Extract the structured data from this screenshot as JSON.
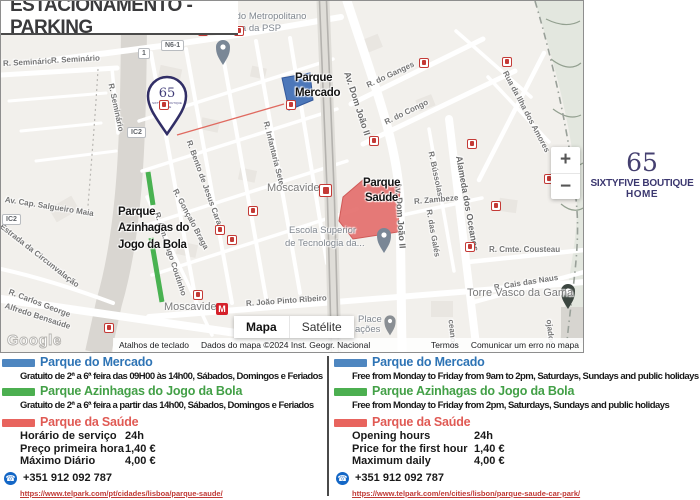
{
  "title": "ESTACIONAMENTO - PARKING",
  "brand": {
    "number": "65",
    "line1": "SIXTYFIVE BOUTIQUE",
    "line2": "HOME"
  },
  "colors": {
    "blue_title": "#2e74b5",
    "green_title": "#43a047",
    "red_title": "#e05a54",
    "blue_swatch": "#4e86c0",
    "green_swatch": "#4caf50",
    "red_swatch": "#e8645e",
    "mercado_area": "#3e6db4",
    "saude_area": "#e4706e",
    "azinhagas_line": "#3fae49"
  },
  "map": {
    "controls": {
      "zoom_in": "+",
      "zoom_out": "−",
      "map_btn": "Mapa",
      "satellite_btn": "Satélite"
    },
    "attribution": {
      "shortcuts": "Atalhos de teclado",
      "data": "Dados do mapa ©2024 Inst. Geogr. Nacional",
      "terms": "Termos",
      "report": "Comunicar um erro no mapa"
    },
    "google_logo": "Google",
    "stations": {
      "metro_label": "M"
    },
    "badges": [
      {
        "t": "N6-1",
        "x": 160,
        "y": 39
      },
      {
        "t": "1",
        "x": 137,
        "y": 47
      },
      {
        "t": "IC2",
        "x": 126,
        "y": 126
      },
      {
        "t": "IC2",
        "x": 1,
        "y": 213
      }
    ],
    "labels": [
      {
        "t": "R. Seminário",
        "x": 2,
        "y": 58,
        "r": -3,
        "c": "st"
      },
      {
        "t": "R. Seminário",
        "x": 50,
        "y": 55,
        "r": -3,
        "c": "st"
      },
      {
        "t": "R. Seminário",
        "x": 110,
        "y": 78,
        "r": 78,
        "c": "st"
      },
      {
        "t": "Av. Cap. Salgueiro Maia",
        "x": 4,
        "y": 194,
        "r": 9,
        "c": "st"
      },
      {
        "t": "Estrada da Circunvalação",
        "x": 0,
        "y": 220,
        "r": 38,
        "c": "st"
      },
      {
        "t": "R. Carlos George",
        "x": 8,
        "y": 286,
        "r": 21,
        "c": "st"
      },
      {
        "t": "Alfredo Bensaúde",
        "x": 4,
        "y": 300,
        "r": 18,
        "c": "st"
      },
      {
        "t": "R. Bento de Jesus Caraça",
        "x": 188,
        "y": 135,
        "r": 70,
        "c": "st"
      },
      {
        "t": "R. Gonçalo Braga",
        "x": 174,
        "y": 184,
        "r": 62,
        "c": "st"
      },
      {
        "t": "R. Alm. Gago Coutinho",
        "x": 156,
        "y": 207,
        "r": 72,
        "c": "st"
      },
      {
        "t": "R. Infantaria Sete",
        "x": 265,
        "y": 116,
        "r": 76,
        "c": "st"
      },
      {
        "t": "Av. Dom João II",
        "x": 346,
        "y": 66,
        "r": 72,
        "c": "lg"
      },
      {
        "t": "Av. Dom João II",
        "x": 397,
        "y": 176,
        "r": 86,
        "c": "lg"
      },
      {
        "t": "R. do Ganges",
        "x": 366,
        "y": 80,
        "r": -25,
        "c": "st"
      },
      {
        "t": "R. do Congo",
        "x": 384,
        "y": 117,
        "r": -26,
        "c": "st"
      },
      {
        "t": "Rua da Ilha dos Amores",
        "x": 504,
        "y": 66,
        "r": 62,
        "c": "st"
      },
      {
        "t": "R. Bússolas",
        "x": 430,
        "y": 146,
        "r": 78,
        "c": "st"
      },
      {
        "t": "R. Zambeze",
        "x": 413,
        "y": 196,
        "r": -5,
        "c": "st"
      },
      {
        "t": "R. das Galés",
        "x": 428,
        "y": 204,
        "r": 80,
        "c": "st"
      },
      {
        "t": "Alameda dos Oceanos",
        "x": 458,
        "y": 150,
        "r": 80,
        "c": "lg"
      },
      {
        "t": "R. Cmte. Cousteau",
        "x": 488,
        "y": 244,
        "r": 0,
        "c": "st"
      },
      {
        "t": "R. Cais das Naus",
        "x": 493,
        "y": 282,
        "r": -9,
        "c": "st"
      },
      {
        "t": "R. João Pinto Ribeiro",
        "x": 245,
        "y": 298,
        "r": -4,
        "c": "st"
      },
      {
        "t": "ceanos",
        "x": 450,
        "y": 314,
        "r": 84,
        "c": "st"
      },
      {
        "t": "ojador",
        "x": 548,
        "y": 314,
        "r": 84,
        "c": "st"
      },
      {
        "t": "Comando Metropolitano",
        "x": 204,
        "y": 10,
        "r": 0,
        "c": "ar"
      },
      {
        "t": "de Lisboa da PSP",
        "x": 204,
        "y": 22,
        "r": 0,
        "c": "ar"
      },
      {
        "t": "Escola Superior",
        "x": 288,
        "y": 224,
        "r": 0,
        "c": "ar"
      },
      {
        "t": "de Tecnologia da...",
        "x": 284,
        "y": 237,
        "r": 0,
        "c": "ar"
      },
      {
        "t": "Place",
        "x": 357,
        "y": 313,
        "r": 0,
        "c": "ar"
      },
      {
        "t": "ações",
        "x": 354,
        "y": 323,
        "r": 0,
        "c": "ar"
      },
      {
        "t": "Moscavide",
        "x": 266,
        "y": 181,
        "r": 0,
        "c": "loc"
      },
      {
        "t": "Moscavide",
        "x": 163,
        "y": 300,
        "r": 0,
        "c": "loc"
      },
      {
        "t": "Torre Vasco da Gama",
        "x": 466,
        "y": 286,
        "r": 0,
        "c": "loc"
      },
      {
        "t": "Parque",
        "x": 294,
        "y": 71,
        "r": 0,
        "c": "poi"
      },
      {
        "t": "Mercado",
        "x": 294,
        "y": 86,
        "r": 0,
        "c": "poi"
      },
      {
        "t": "Parque",
        "x": 362,
        "y": 176,
        "r": 0,
        "c": "poi"
      },
      {
        "t": "Saúde",
        "x": 364,
        "y": 191,
        "r": 0,
        "c": "poi"
      },
      {
        "t": "Parque",
        "x": 117,
        "y": 205,
        "r": 0,
        "c": "poi"
      },
      {
        "t": "Azinhagas do",
        "x": 117,
        "y": 221,
        "r": 0,
        "c": "poi"
      },
      {
        "t": "Jogo da Bola",
        "x": 117,
        "y": 238,
        "r": 0,
        "c": "poi"
      }
    ],
    "transit_stops": [
      [
        197,
        25
      ],
      [
        233,
        25
      ],
      [
        158,
        99
      ],
      [
        285,
        99
      ],
      [
        418,
        57
      ],
      [
        368,
        135
      ],
      [
        466,
        138
      ],
      [
        247,
        205
      ],
      [
        214,
        224
      ],
      [
        226,
        234
      ],
      [
        490,
        200
      ],
      [
        464,
        241
      ],
      [
        543,
        173
      ],
      [
        192,
        289
      ],
      [
        103,
        322
      ],
      [
        501,
        56
      ]
    ]
  },
  "legend": {
    "pt": {
      "mercado_title": "Parque do Mercado",
      "mercado_desc": "Gratuito de 2ª a 6ª feira das 09H00 às 14h00, Sábados, Domingos e Feriados",
      "azinhagas_title": "Parque Azinhagas do Jogo da Bola",
      "azinhagas_desc": "Gratuito de 2ª a 6ª feira a partir das 14h00, Sábados, Domingos e Feriados",
      "saude_title": "Parque da Saúde",
      "rows": [
        [
          "Horário de serviço",
          "24h"
        ],
        [
          "Preço primeira hora",
          "1,40 €"
        ],
        [
          "Máximo Diário",
          "4,00 €"
        ]
      ],
      "phone": "+351 912 092 787",
      "url": "https://www.telpark.com/pt/cidades/lisboa/parque-saude/"
    },
    "en": {
      "mercado_title": "Parque do Mercado",
      "mercado_desc": "Free from Monday to Friday from 9am to 2pm, Saturdays, Sundays and public holidays",
      "azinhagas_title": "Parque Azinhagas do Jogo da Bola",
      "azinhagas_desc": "Free from Monday to Friday from 2pm, Saturdays, Sundays and public holidays",
      "saude_title": "Parque da Saúde",
      "rows": [
        [
          "Opening hours",
          "24h"
        ],
        [
          "Price for the first hour",
          "1,40 €"
        ],
        [
          "Maximum daily",
          "4,00 €"
        ]
      ],
      "phone": "+351 912 092 787",
      "url": "https://www.telpark.com/en/cities/lisbon/parque-saude-car-park/"
    }
  }
}
